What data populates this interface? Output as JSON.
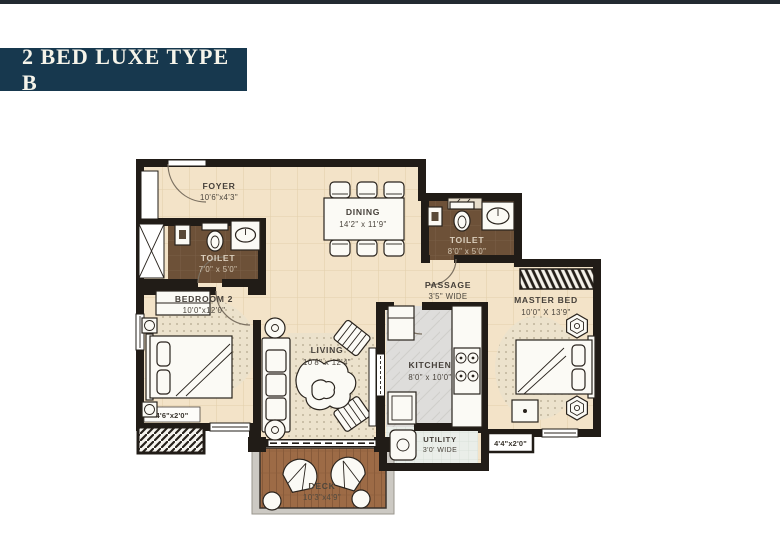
{
  "title": {
    "text": "2 BED LUXE TYPE B"
  },
  "colors": {
    "top_bar": "#222a31",
    "title_bg": "#17384e",
    "title_text": "#f6f4ea",
    "wall": "#211c17",
    "floor_cream": "#f3e3c8",
    "floor_toilet": "#6d5138",
    "floor_deck": "#9c6a45",
    "floor_kitchen": "#dedede",
    "label_dark": "#46403a",
    "label_light": "#dbcfbd"
  },
  "plan": {
    "rooms": [
      {
        "id": "foyer",
        "name": "FOYER",
        "dims": "10'6\"x4'3\""
      },
      {
        "id": "dining",
        "name": "DINING",
        "dims": "14'2\" x 11'9\""
      },
      {
        "id": "toilet-1",
        "name": "TOILET",
        "dims": "7'0\" x 5'0\""
      },
      {
        "id": "toilet-2",
        "name": "TOILET",
        "dims": "8'0\" x 5'0\""
      },
      {
        "id": "passage",
        "name": "PASSAGE",
        "dims": "3'5\" WIDE"
      },
      {
        "id": "bedroom-2",
        "name": "BEDROOM 2",
        "dims": "10'0\"x12'0\""
      },
      {
        "id": "living",
        "name": "LIVING",
        "dims": "10'8\" x 12'4\""
      },
      {
        "id": "kitchen",
        "name": "KITCHEN",
        "dims": "8'0\" x 10'0\""
      },
      {
        "id": "master-bed",
        "name": "MASTER BED",
        "dims": "10'0\" X 13'9\""
      },
      {
        "id": "utility",
        "name": "UTILITY",
        "dims": "3'0' WIDE"
      },
      {
        "id": "deck",
        "name": "DECK",
        "dims": "10'3\"x4'9\""
      }
    ],
    "ledges": [
      {
        "text": "4'6\"x2'0\""
      },
      {
        "text": "4'4\"x2'0\""
      }
    ]
  }
}
